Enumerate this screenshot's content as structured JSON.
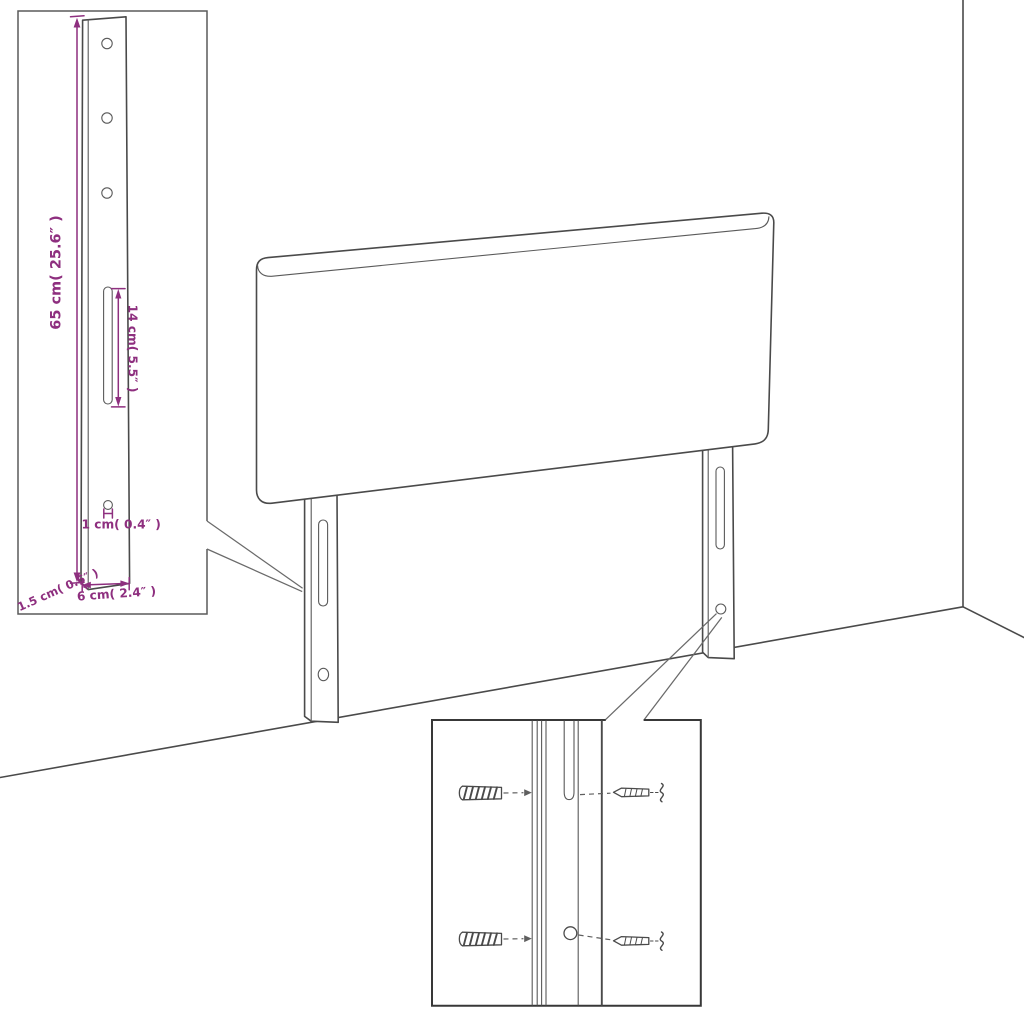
{
  "figure": {
    "kind": "product-dimension-diagram",
    "accent_color": "#8e2f7f",
    "line_color": "#4a4a4a"
  },
  "dimensions": {
    "height": "65 cm( 25.6″ )",
    "slot": "14 cm( 5.5″ )",
    "hole": "1 cm( 0.4″ )",
    "thickness": "1.5 cm( 0.6″ )",
    "width": "6 cm( 2.4″ )"
  }
}
